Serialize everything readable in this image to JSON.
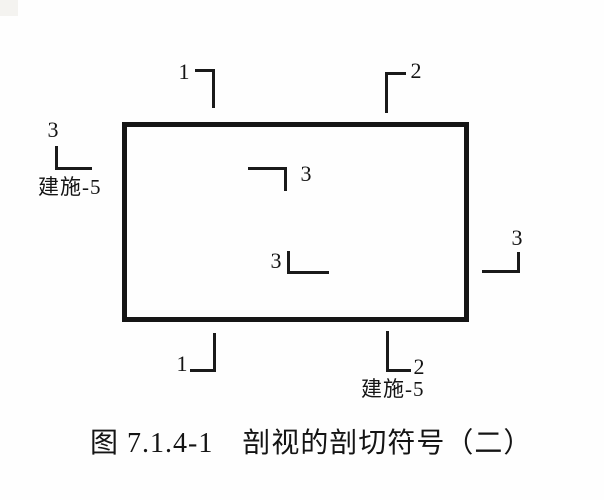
{
  "figure": {
    "caption": "图 7.1.4-1　剖视的剖切符号（二）",
    "colors": {
      "line": "#1a1a1a",
      "background": "#fefefe"
    }
  },
  "diagram": {
    "plan_outline": "rectangle",
    "marks": {
      "top_1": {
        "number": "1"
      },
      "top_2": {
        "number": "2"
      },
      "left_3": {
        "number": "3",
        "ref_label": "建施-5"
      },
      "inner_upper_3": {
        "number": "3"
      },
      "inner_lower_3": {
        "number": "3"
      },
      "right_3": {
        "number": "3"
      },
      "bottom_1": {
        "number": "1"
      },
      "bottom_2": {
        "number": "2",
        "ref_label": "建施-5"
      }
    }
  }
}
